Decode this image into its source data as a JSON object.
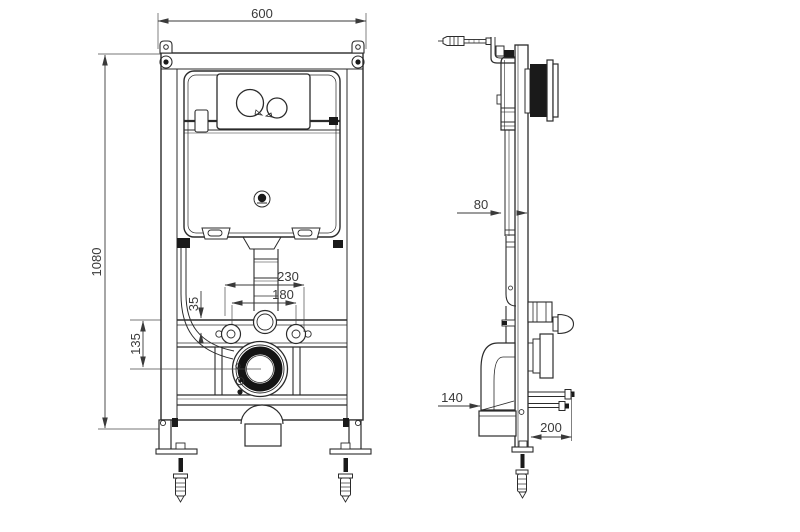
{
  "drawing": {
    "type": "technical-installation-diagram",
    "subject": "concealed-cistern-wc-wall-frame",
    "background_color": "#ffffff",
    "line_color": "#2b2b2b",
    "dim_color": "#3a3a3a",
    "views": {
      "front_view": {
        "name": "front view",
        "dims": {
          "frame_width": "600",
          "frame_height": "1080",
          "upper_span": "230",
          "bolt_spacing": "180",
          "rail_depth": "35",
          "outlet_drop": "135"
        }
      },
      "side_view": {
        "name": "side view",
        "dims": {
          "frame_depth": "80",
          "bend_reach": "140",
          "base_span": "200"
        }
      }
    }
  }
}
